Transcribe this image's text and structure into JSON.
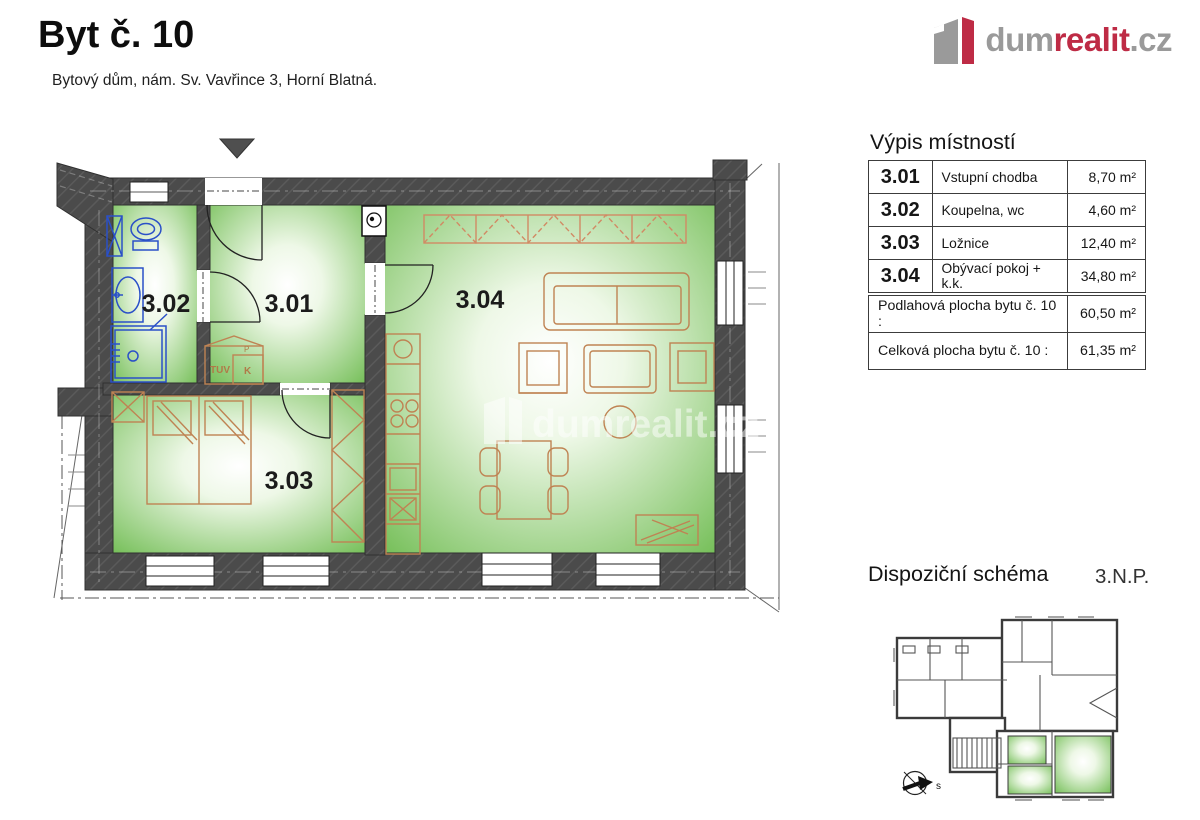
{
  "header": {
    "title": "Byt č. 10",
    "subtitle": "Bytový dům, nám. Sv. Vavřince 3, Horní Blatná."
  },
  "logo": {
    "part_gray1": "dum",
    "part_red": "realit",
    "part_gray2": ".cz",
    "color_red": "#be2b45",
    "color_gray": "#9a9a9a"
  },
  "plan": {
    "room_labels": {
      "r301": "3.01",
      "r302": "3.02",
      "r303": "3.03",
      "r304": "3.04"
    },
    "closet_labels": {
      "tuv": "TUV",
      "p": "P",
      "k": "K"
    },
    "watermark": "dumrealit.cz",
    "colors": {
      "wall": "#4b4b4b",
      "room_green": "#6cbb4d",
      "furniture": "#bf8353",
      "fixtures_blue": "#2a50c8"
    }
  },
  "room_table": {
    "title": "Výpis místností",
    "rows": [
      {
        "num": "3.01",
        "name": "Vstupní chodba",
        "area": "8,70 m²"
      },
      {
        "num": "3.02",
        "name": "Koupelna, wc",
        "area": "4,60 m²"
      },
      {
        "num": "3.03",
        "name": "Ložnice",
        "area": "12,40 m²"
      },
      {
        "num": "3.04",
        "name": "Obývací pokoj + k.k.",
        "area": "34,80 m²"
      }
    ],
    "totals": [
      {
        "label": "Podlahová plocha bytu  č. 10 :",
        "area": "60,50 m²"
      },
      {
        "label": "Celková plocha bytu  č. 10 :",
        "area": "61,35 m²"
      }
    ]
  },
  "schema": {
    "title": "Dispoziční schéma",
    "floor": "3.N.P.",
    "compass_label": "s"
  }
}
